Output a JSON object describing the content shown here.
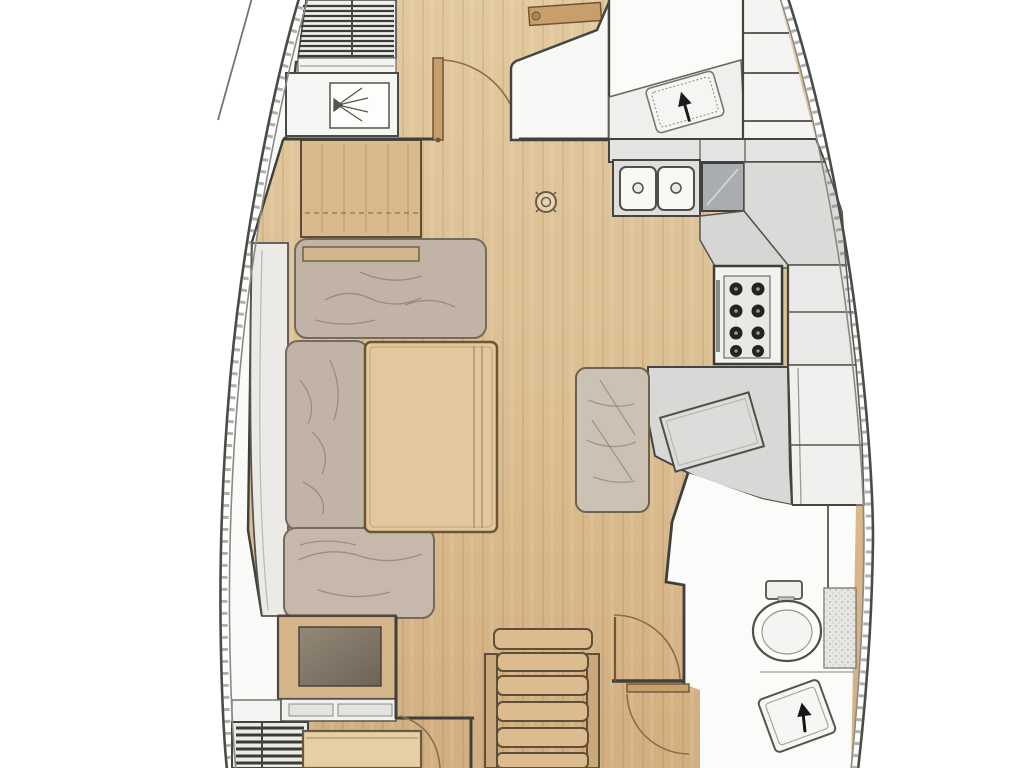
{
  "page": {
    "title": "Sailing yacht interior layout — floor plan (bow up, stern down)"
  },
  "diagram": {
    "type": "floor-plan",
    "subject": "sailing-yacht-saloon-deck",
    "orientation": {
      "bow": "top",
      "stern": "bottom"
    },
    "rooms": [
      {
        "id": "forward-cabin",
        "name": "Forward cabin",
        "features": [
          "slatted berth base",
          "hanging locker with fan symbol",
          "entry door with swing arc"
        ]
      },
      {
        "id": "forward-head",
        "name": "Forward head",
        "features": [
          "vanity counter",
          "tilted wash basin",
          "black faucet arrow"
        ]
      },
      {
        "id": "saloon",
        "name": "Saloon",
        "features": [
          "U-shaped settee with cushions",
          "folding saloon table",
          "sideboard cabinet",
          "overhead deck hatch symbol"
        ]
      },
      {
        "id": "galley",
        "name": "Galley",
        "features": [
          "double sink",
          "top-loading icebox",
          "gimballed stove with burner grid",
          "worktops",
          "hull-side lockers"
        ]
      },
      {
        "id": "nav-station",
        "name": "Navigation station",
        "features": [
          "tilted chart table",
          "navigator bench seat"
        ]
      },
      {
        "id": "aft-head",
        "name": "Aft head",
        "features": [
          "marine toilet with cistern",
          "tilted wash basin",
          "black faucet arrow",
          "stippled vanity shelf"
        ]
      },
      {
        "id": "companionway",
        "name": "Companionway",
        "features": [
          "ladder with six treads"
        ]
      },
      {
        "id": "aft-cabin-port",
        "name": "Port aft cabin entrance",
        "features": [
          "dark seat locker",
          "white shelf with slats",
          "louvered step block",
          "berth edge",
          "door swing arc"
        ]
      },
      {
        "id": "aft-cabin-stbd",
        "name": "Starboard aft cabin entrance",
        "features": [
          "door leaf",
          "door swing arc"
        ]
      }
    ],
    "counts": {
      "sink_basins": 2,
      "stove_burners": 8,
      "ladder_treads": 6,
      "berth_slats": 11,
      "door_swings": 5,
      "hull_locker_compartments": 10
    },
    "colors": {
      "floor_wood_light": "#e3c99f",
      "floor_wood_dark": "#d2ae80",
      "cushion_grey": "#c1b3a6",
      "cushion_back_white": "#eceae6",
      "table_wood": "#e2c89c",
      "sideboard_wood": "#d9ba8c",
      "counter_grey": "#dadad8",
      "appliance_grey": "#a9adaf",
      "white_surface": "#f8f8f6",
      "dark_seat": "#7a6e60",
      "door_wood": "#c89e6a",
      "hull_line": "#4a4a46",
      "wall_line": "#3f3f3b",
      "accent_black": "#1c1c1a"
    }
  },
  "labels": {
    "svg_title": "Sailboat interior layout floor plan"
  }
}
